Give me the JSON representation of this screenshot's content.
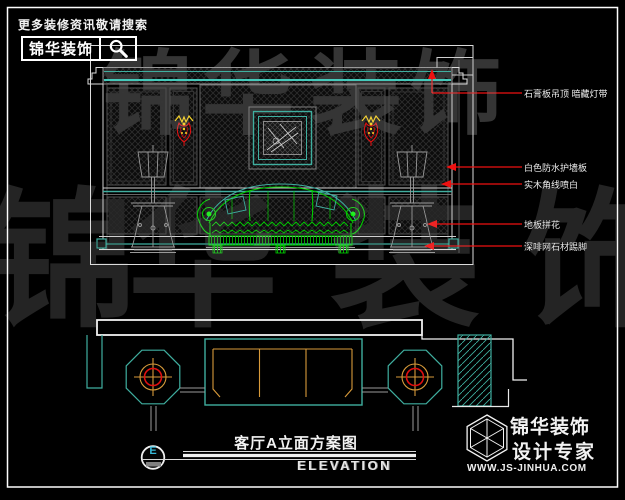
{
  "brand_header": {
    "tagline": "更多装修资讯敬请搜索",
    "logo_text": "锦华装饰",
    "search_icon": "magnifier"
  },
  "annotations": {
    "items": [
      {
        "label": "石膏板吊顶 暗藏灯带"
      },
      {
        "label": "白色防水护墙板"
      },
      {
        "label": "实木角线喷白"
      },
      {
        "label": "地板拼花"
      },
      {
        "label": "深啡网石材踢脚"
      }
    ],
    "leader_color": "#ee1111"
  },
  "title_block": {
    "drawing_title": "客厅A立面方案图",
    "drawing_subtitle": "ELEVATION",
    "marker_letter": "E"
  },
  "footer_logo": {
    "company": "锦华装饰",
    "slogan": "设计专家",
    "website": "WWW.JS-JINHUA.COM",
    "logo_icon": "wireframe-cube-hexagon"
  },
  "watermark": {
    "text": "锦华装饰",
    "chars": [
      "锦",
      "华",
      "装",
      "饰"
    ]
  },
  "colors": {
    "background": "#000000",
    "line_white": "#f0f0f0",
    "cad_teal": "#3fae9f",
    "cad_green": "#00cc00",
    "cad_orange": "#d89a3a",
    "cad_red": "#ee1111",
    "panel_hatch": "#2d2d2d"
  }
}
